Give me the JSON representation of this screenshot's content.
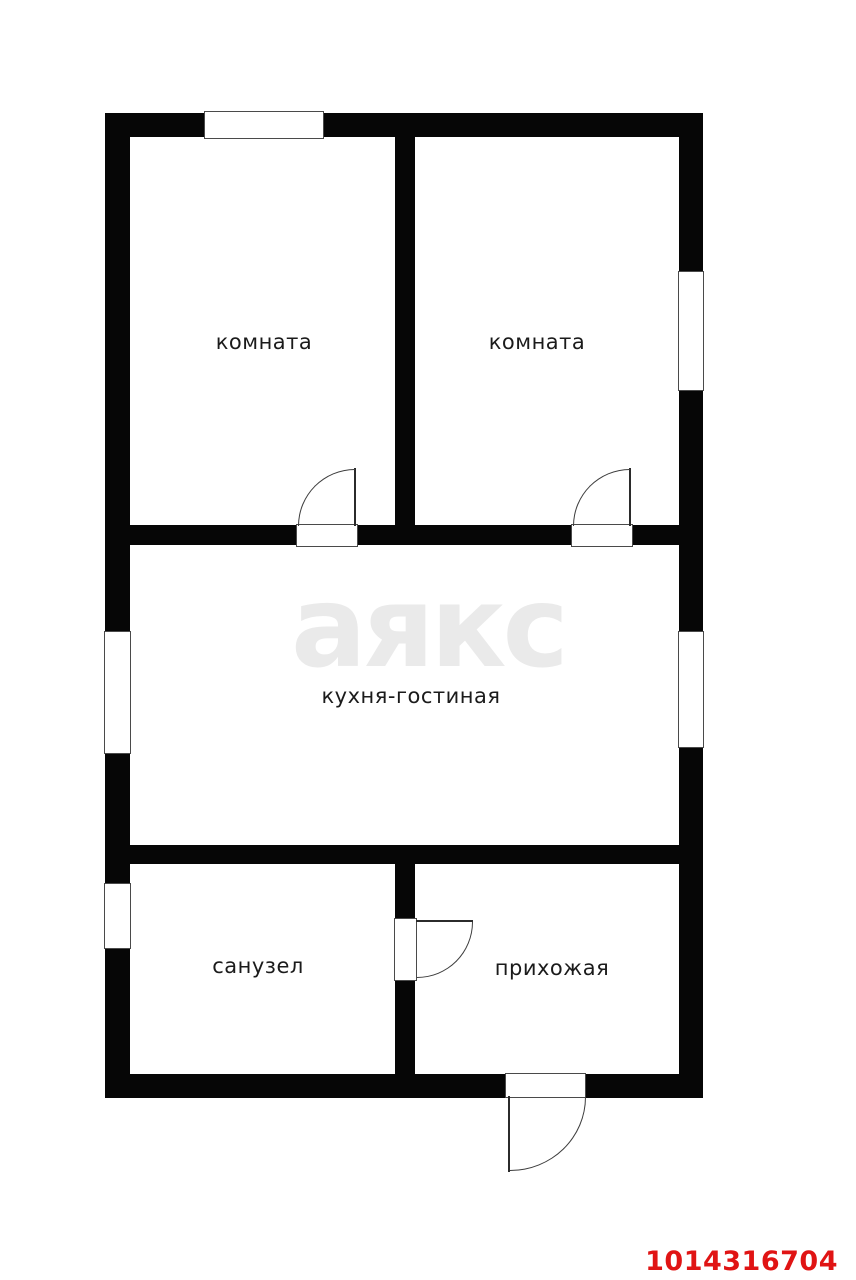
{
  "page": {
    "background": "#ffffff"
  },
  "floor_plan": {
    "watermark_text": "аякс",
    "listing_id": "1014316704",
    "colors": {
      "wall": "#060606",
      "room_label": "#1b1b1b",
      "watermark": "#eaeaea",
      "listing_id_red": "#e01414",
      "opening_outline": "#4a4a4a"
    },
    "rooms": [
      {
        "name": "room-1",
        "label": "комната"
      },
      {
        "name": "room-2",
        "label": "комната"
      },
      {
        "name": "kitchen-living",
        "label": "кухня-гостиная"
      },
      {
        "name": "bathroom",
        "label": "санузел"
      },
      {
        "name": "hallway",
        "label": "прихожая"
      }
    ],
    "elements": {
      "windows": [
        "window-top-room-1",
        "window-right-room-2",
        "window-left-kitchen",
        "window-right-kitchen",
        "window-left-bathroom"
      ],
      "doors": [
        "door-room-1",
        "door-room-2",
        "door-bathroom",
        "door-entrance"
      ]
    }
  }
}
